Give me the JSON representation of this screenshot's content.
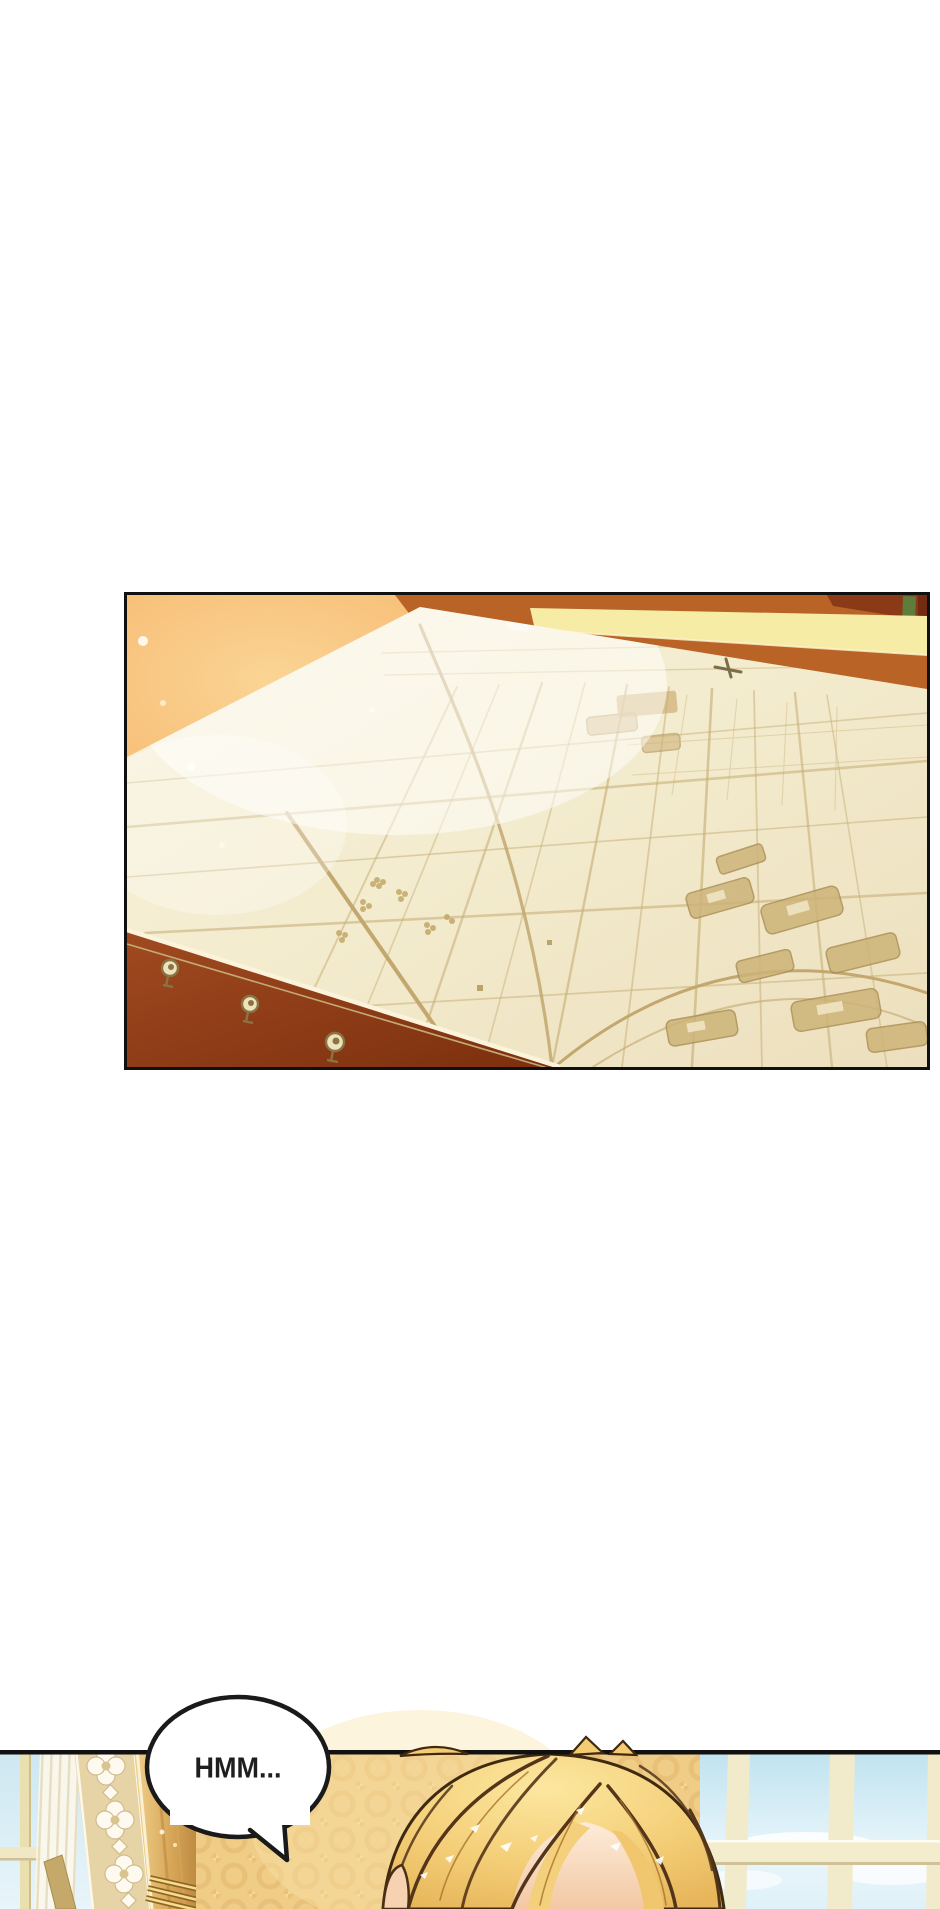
{
  "page": {
    "background": "#ffffff",
    "kind": "comic-page"
  },
  "speech_bubble": {
    "text": "HMM...",
    "fill": "#ffffff",
    "stroke": "#1a1a1a",
    "text_color": "#1e1e1e"
  },
  "panels": {
    "map_panel": {
      "name": "map-on-table-panel",
      "border_color": "#101010",
      "colors": {
        "table_glow": "#f4b469",
        "glow_highlight": "#fbd494",
        "wall_band_yellow": "#f6eca6",
        "table_edge_orange": "#b96426",
        "table_front_dark": "#8e3d17",
        "paper": "#f4ecd2",
        "map_ink": "#c8b07a",
        "greenery": "#5f7d3a"
      }
    },
    "character_panel": {
      "name": "character-window-panel",
      "border_color": "#111111",
      "colors": {
        "sky": "#cde7f1",
        "mullion_cream": "#f0e8c6",
        "damask_wall": "#efcd86",
        "damask_motif": "#e3b66b",
        "lace_column": "#e6d4a6",
        "lace_white": "#fefaf0",
        "gold_curtain": "#d8a859",
        "hair_base": "#f4cf79",
        "hair_light": "#fce79f",
        "hair_outline": "#462d11",
        "skin": "#f8ddc4"
      }
    }
  }
}
